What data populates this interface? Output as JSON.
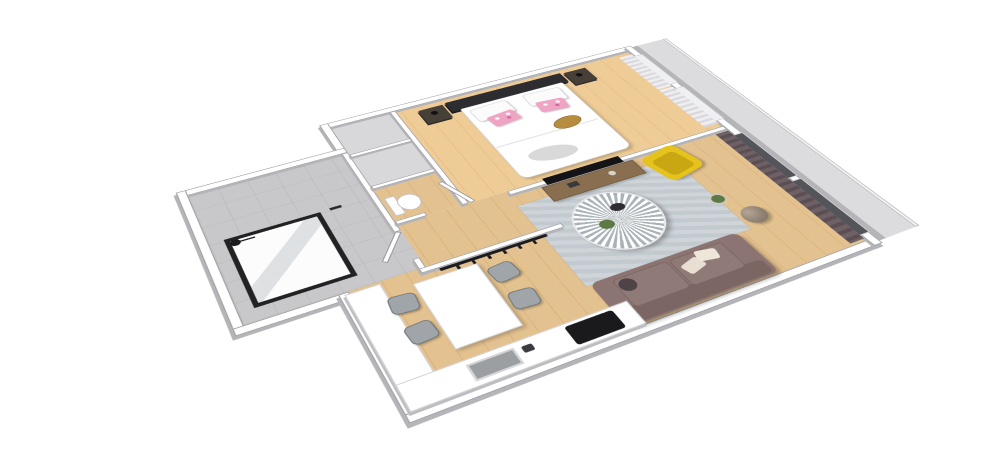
{
  "scene": {
    "description": "3D axonometric floor plan of a one-bedroom apartment, no visible text",
    "background": "#ffffff",
    "palette": {
      "background": "#ffffff",
      "wall_top": "#ffffff",
      "wall_face": "#b5b5b9",
      "wood_floor": "#e4c28f",
      "bath_floor": "#c8c8ca",
      "closet_floor": "#d8d8da",
      "rug": "#ced4d8",
      "sofa": "#8b7471",
      "sofa_cushion": "#907a77",
      "armchair_yellow": "#e6c31c",
      "curtain_dark": "#6e6065",
      "curtain_light": "#e6e6e9",
      "headboard": "#2d2d31",
      "bed_linen": "#ffffff",
      "pillow_pink": "#f0a4c4",
      "tray_gold": "#b68c3e",
      "throw_gray": "#d9d9d9",
      "console_wood": "#8a6e50",
      "tv_black": "#141416",
      "counter_white": "#ffffff",
      "cooktop_black": "#1a1a1c",
      "sink_gray": "#9b9fa2",
      "chair": "#9fa5a9",
      "table_white": "#ffffff",
      "toilet_white": "#ffffff",
      "shower_frame": "#222225",
      "balcony_floor": "#dcdcde",
      "railing": "#f2f2f4",
      "lamp_sphere": "#8b7d6d",
      "plant_green": "#5d7a46",
      "nightstand": "#474039",
      "coat_rack": "#1b1b1d",
      "window_glass_dark": "#53555a"
    },
    "rooms": [
      {
        "name": "bedroom"
      },
      {
        "name": "bathroom"
      },
      {
        "name": "wc-wardrobe-column"
      },
      {
        "name": "hallway"
      },
      {
        "name": "kitchen-dining"
      },
      {
        "name": "living-room"
      },
      {
        "name": "balcony"
      }
    ],
    "furniture": [
      {
        "name": "double-bed",
        "room": "bedroom"
      },
      {
        "name": "nightstand-left",
        "room": "bedroom"
      },
      {
        "name": "nightstand-right",
        "room": "bedroom"
      },
      {
        "name": "walk-in-shower",
        "room": "bathroom"
      },
      {
        "name": "toilet",
        "room": "wc-wardrobe-column"
      },
      {
        "name": "wardrobe-cells",
        "room": "wc-wardrobe-column"
      },
      {
        "name": "coat-rack",
        "room": "hallway"
      },
      {
        "name": "kitchen-counter-l-shape",
        "room": "kitchen-dining"
      },
      {
        "name": "sink",
        "room": "kitchen-dining"
      },
      {
        "name": "cooktop",
        "room": "kitchen-dining"
      },
      {
        "name": "dining-table",
        "room": "kitchen-dining"
      },
      {
        "name": "dining-chairs",
        "count": 4,
        "room": "kitchen-dining"
      },
      {
        "name": "tv",
        "room": "living-room"
      },
      {
        "name": "tv-console",
        "room": "living-room"
      },
      {
        "name": "round-sunburst-coffee-table",
        "room": "living-room"
      },
      {
        "name": "yellow-armchair",
        "room": "living-room"
      },
      {
        "name": "sofa",
        "room": "living-room"
      },
      {
        "name": "sphere-floor-lamp",
        "room": "living-room"
      },
      {
        "name": "area-rug",
        "room": "living-room"
      },
      {
        "name": "dark-curtains",
        "room": "living-room"
      },
      {
        "name": "light-curtains",
        "room": "bedroom"
      }
    ]
  }
}
